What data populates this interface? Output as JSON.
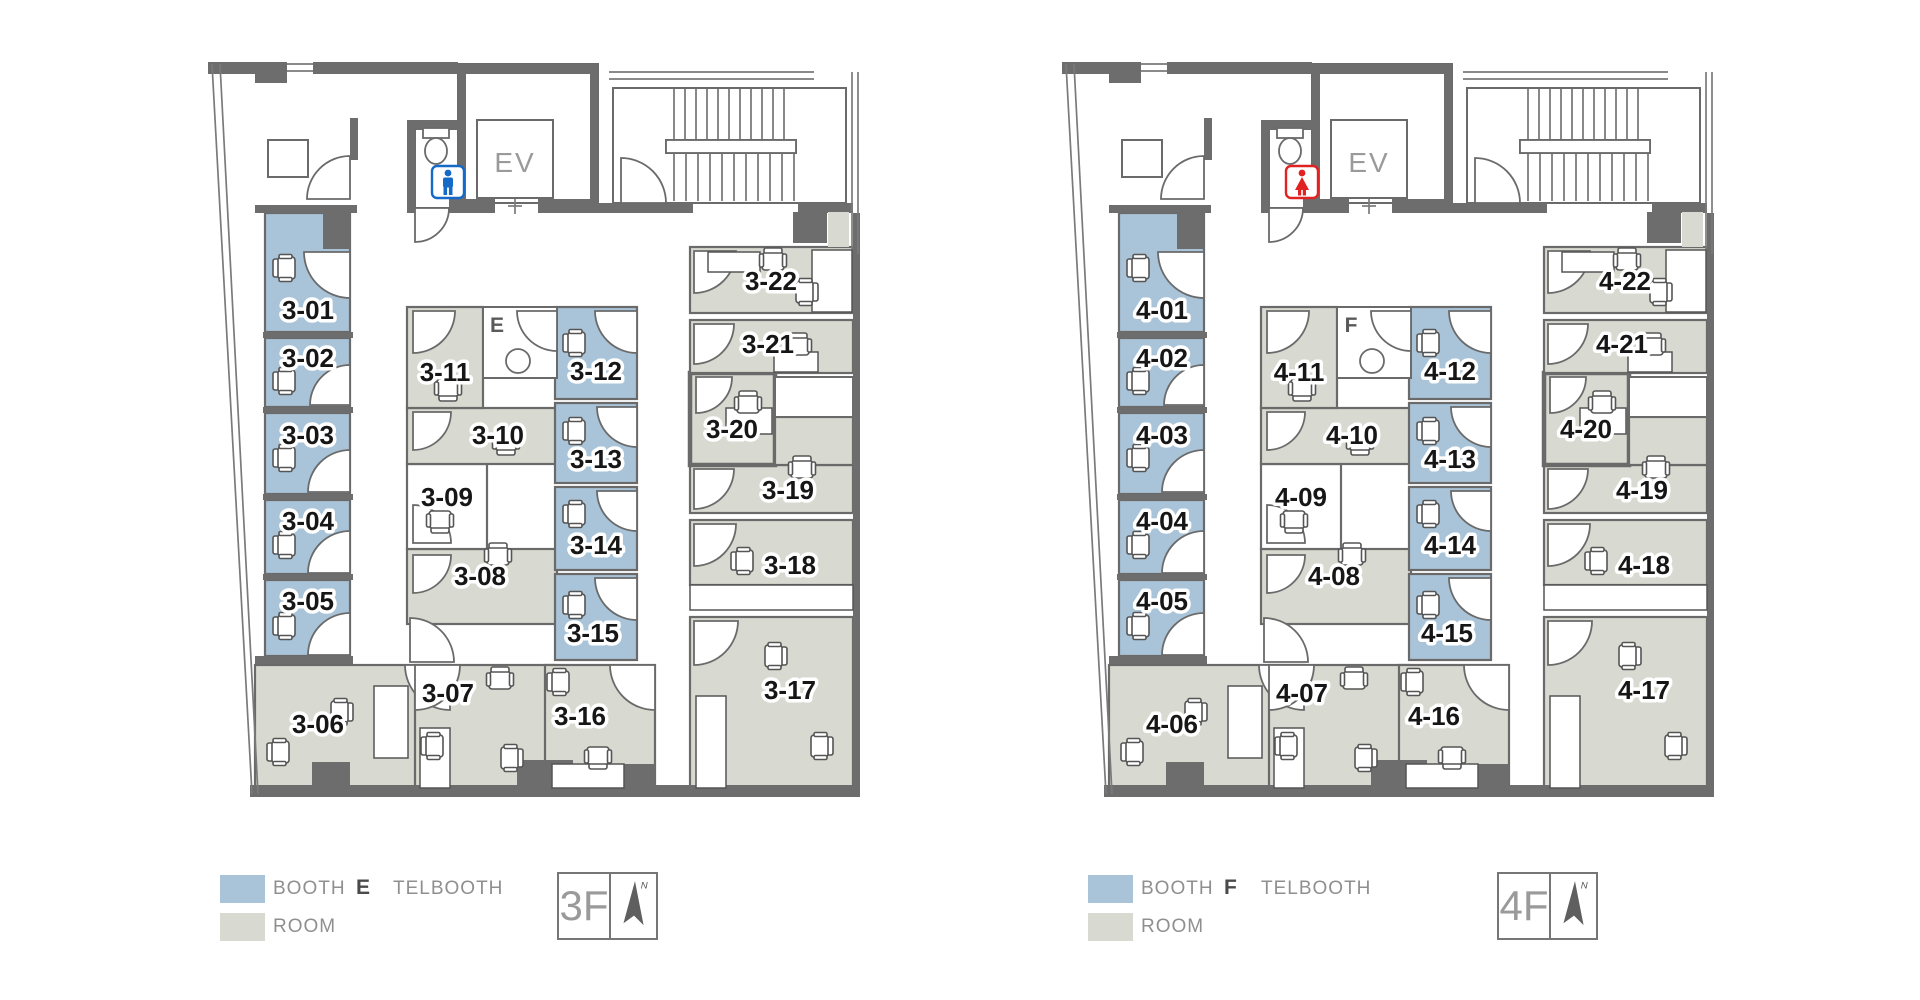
{
  "colors": {
    "booth": "#a9c4d8",
    "room": "#d8d9d0",
    "wall": "#6d6d6d",
    "line": "#6a6a6a",
    "label": "#161616",
    "ev_text": "#9a9a9a",
    "legend_text": "#8f8f8f",
    "floor_text": "#9a9a9a",
    "male": "#1569c7",
    "female": "#e02222",
    "compass": "#5f5f5f"
  },
  "floors": [
    {
      "name": "3F",
      "ev_label": "EV",
      "telbooth_letter": "E",
      "telbooth_label": "TELBOOTH",
      "restroom": "male",
      "compass_n": "N",
      "legend": {
        "booth_label": "BOOTH",
        "room_label": "ROOM"
      },
      "rooms": [
        "3-01",
        "3-02",
        "3-03",
        "3-04",
        "3-05",
        "3-06",
        "3-07",
        "3-08",
        "3-09",
        "3-10",
        "3-11",
        "3-12",
        "3-13",
        "3-14",
        "3-15",
        "3-16",
        "3-17",
        "3-18",
        "3-19",
        "3-20",
        "3-21",
        "3-22"
      ]
    },
    {
      "name": "4F",
      "ev_label": "EV",
      "telbooth_letter": "F",
      "telbooth_label": "TELBOOTH",
      "restroom": "female",
      "compass_n": "N",
      "legend": {
        "booth_label": "BOOTH",
        "room_label": "ROOM"
      },
      "rooms": [
        "4-01",
        "4-02",
        "4-03",
        "4-04",
        "4-05",
        "4-06",
        "4-07",
        "4-08",
        "4-09",
        "4-10",
        "4-11",
        "4-12",
        "4-13",
        "4-14",
        "4-15",
        "4-16",
        "4-17",
        "4-18",
        "4-19",
        "4-20",
        "4-21",
        "4-22"
      ]
    }
  ]
}
